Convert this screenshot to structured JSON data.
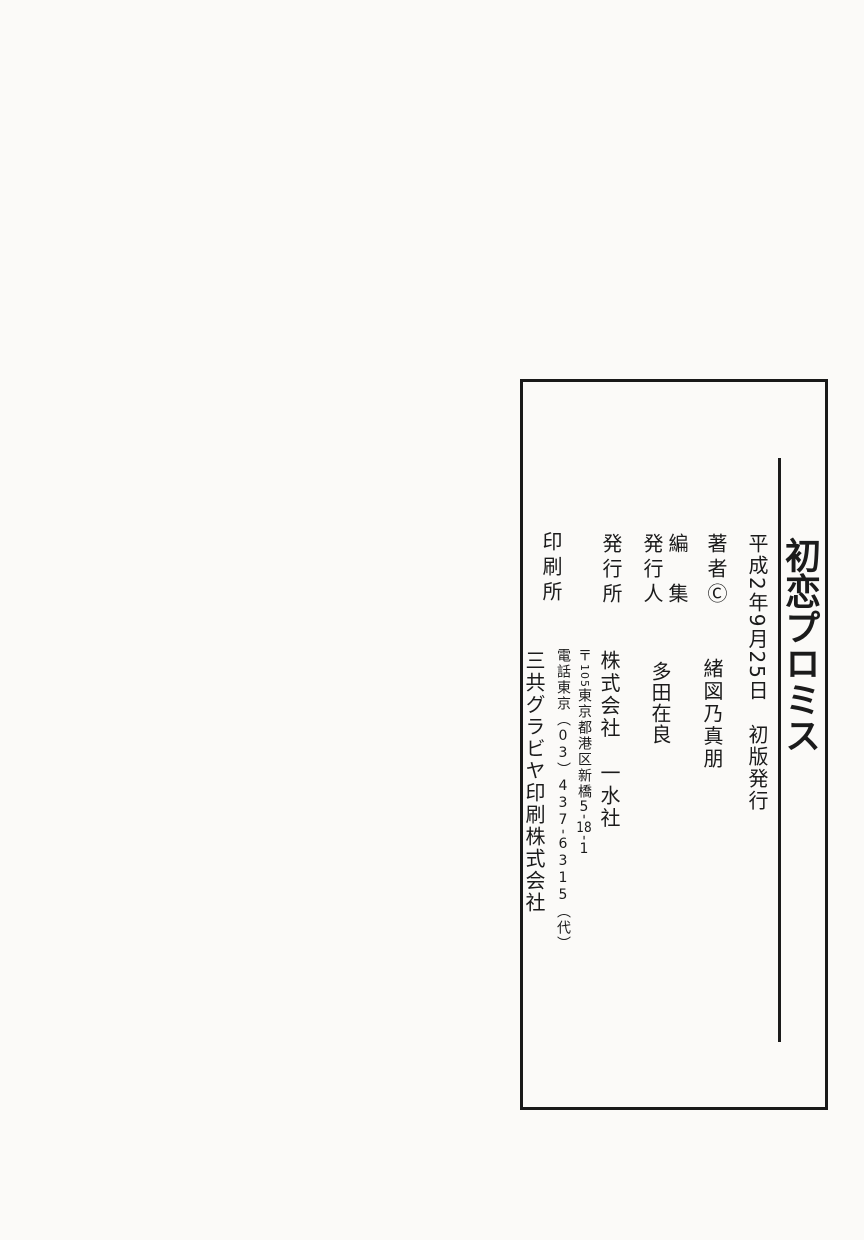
{
  "colors": {
    "paper": "#fbfaf8",
    "ink": "#1b1b1b"
  },
  "colophon": {
    "title": "初恋プロミス",
    "edition_line": "平成2年9月25日　初版発行",
    "author": {
      "label": "著者",
      "copyright_mark": "Ⓒ",
      "name": "緒図乃真朋"
    },
    "editor": {
      "label": "編　集"
    },
    "issuer": {
      "label": "発行人",
      "name": "多田在良"
    },
    "publisher": {
      "label": "発行所",
      "name": "株式会社　一水社"
    },
    "address": {
      "postal_mark": "〒",
      "postal_code": "105",
      "street": "東京都港区新橋",
      "block_a": "5",
      "block_sep1": "-",
      "block_b": "18",
      "block_sep2": "-",
      "block_c": "1"
    },
    "phone": {
      "prefix": "電話東京",
      "open_paren": "（",
      "area_code": "03",
      "close_paren": "）",
      "number_a": "437",
      "separator": "-",
      "number_b": "6315",
      "note": "（代）"
    },
    "printer": {
      "label": "印刷所",
      "name": "三共グラビヤ印刷株式会社"
    }
  }
}
